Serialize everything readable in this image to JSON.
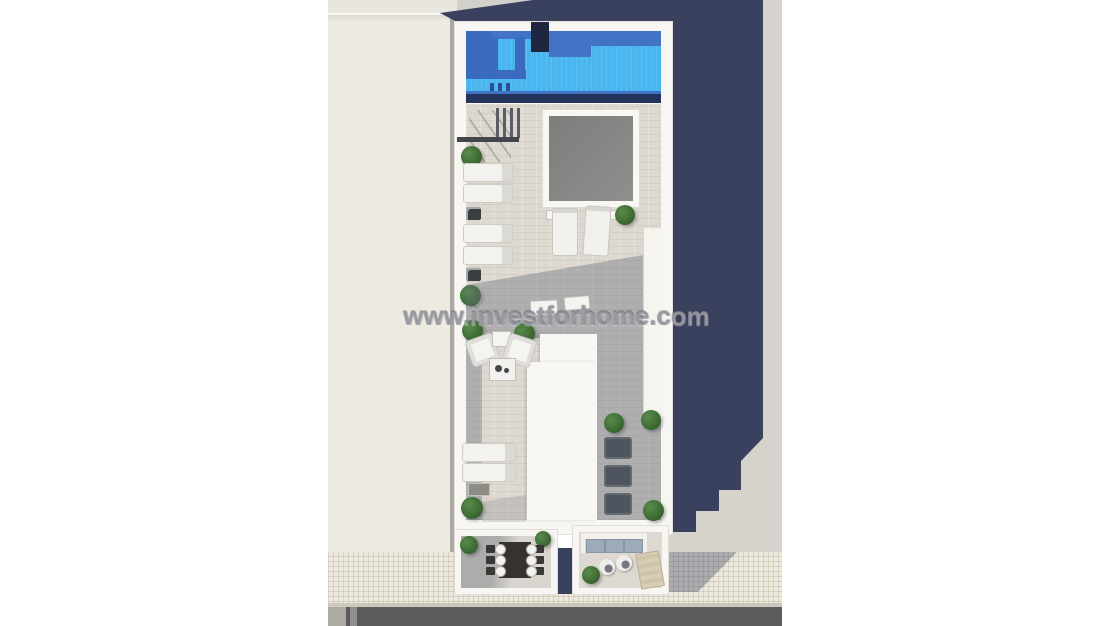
{
  "watermark": {
    "text": "www.investforhome.com"
  },
  "scene": {
    "type": "aerial-architectural-render",
    "subject": "Top-down 3D render of a rooftop solarium floor plan with swimming pool, sun deck, lounge areas and two lower terraces, flanked by an adjacent roof, sidewalk and road"
  },
  "palette": {
    "page_background": "#ffffff",
    "pool_water": "#49b6ef",
    "pool_step_blue": "#3a6bbf",
    "pool_edge_dark": "#24335c",
    "cast_shadow_navy": "#39415e",
    "roof_tile_light": "#ded9d0",
    "roof_tile_shaded": "#9fa2ac",
    "structure_white": "#f7f6f3",
    "adjacent_roof_cream": "#eceae1",
    "ground_gray": "#d5d3cc",
    "skylight_gray": "#8a8886",
    "sidewalk_tile": "#ece8de",
    "road_asphalt": "#5c5c5e",
    "plant_green": "#3c6a33",
    "sofa_cushion_blue": "#9daab8"
  },
  "objects": [
    {
      "name": "swimming-pool",
      "count": 1
    },
    {
      "name": "pool-steps",
      "count": 1
    },
    {
      "name": "roof-access-chimney",
      "count": 1
    },
    {
      "name": "skylight",
      "count": 1
    },
    {
      "name": "sun-loungers",
      "count": 11
    },
    {
      "name": "armchairs",
      "count": 2
    },
    {
      "name": "coffee-table",
      "count": 1
    },
    {
      "name": "dining-table-six-seats",
      "count": 1
    },
    {
      "name": "outdoor-sofa",
      "count": 1
    },
    {
      "name": "round-poufs",
      "count": 2
    },
    {
      "name": "hammock-lounger",
      "count": 1
    },
    {
      "name": "potted-plants",
      "count": 12
    },
    {
      "name": "adjacent-building-roof",
      "count": 1
    },
    {
      "name": "sidewalk",
      "count": 1
    },
    {
      "name": "road",
      "count": 1
    }
  ]
}
